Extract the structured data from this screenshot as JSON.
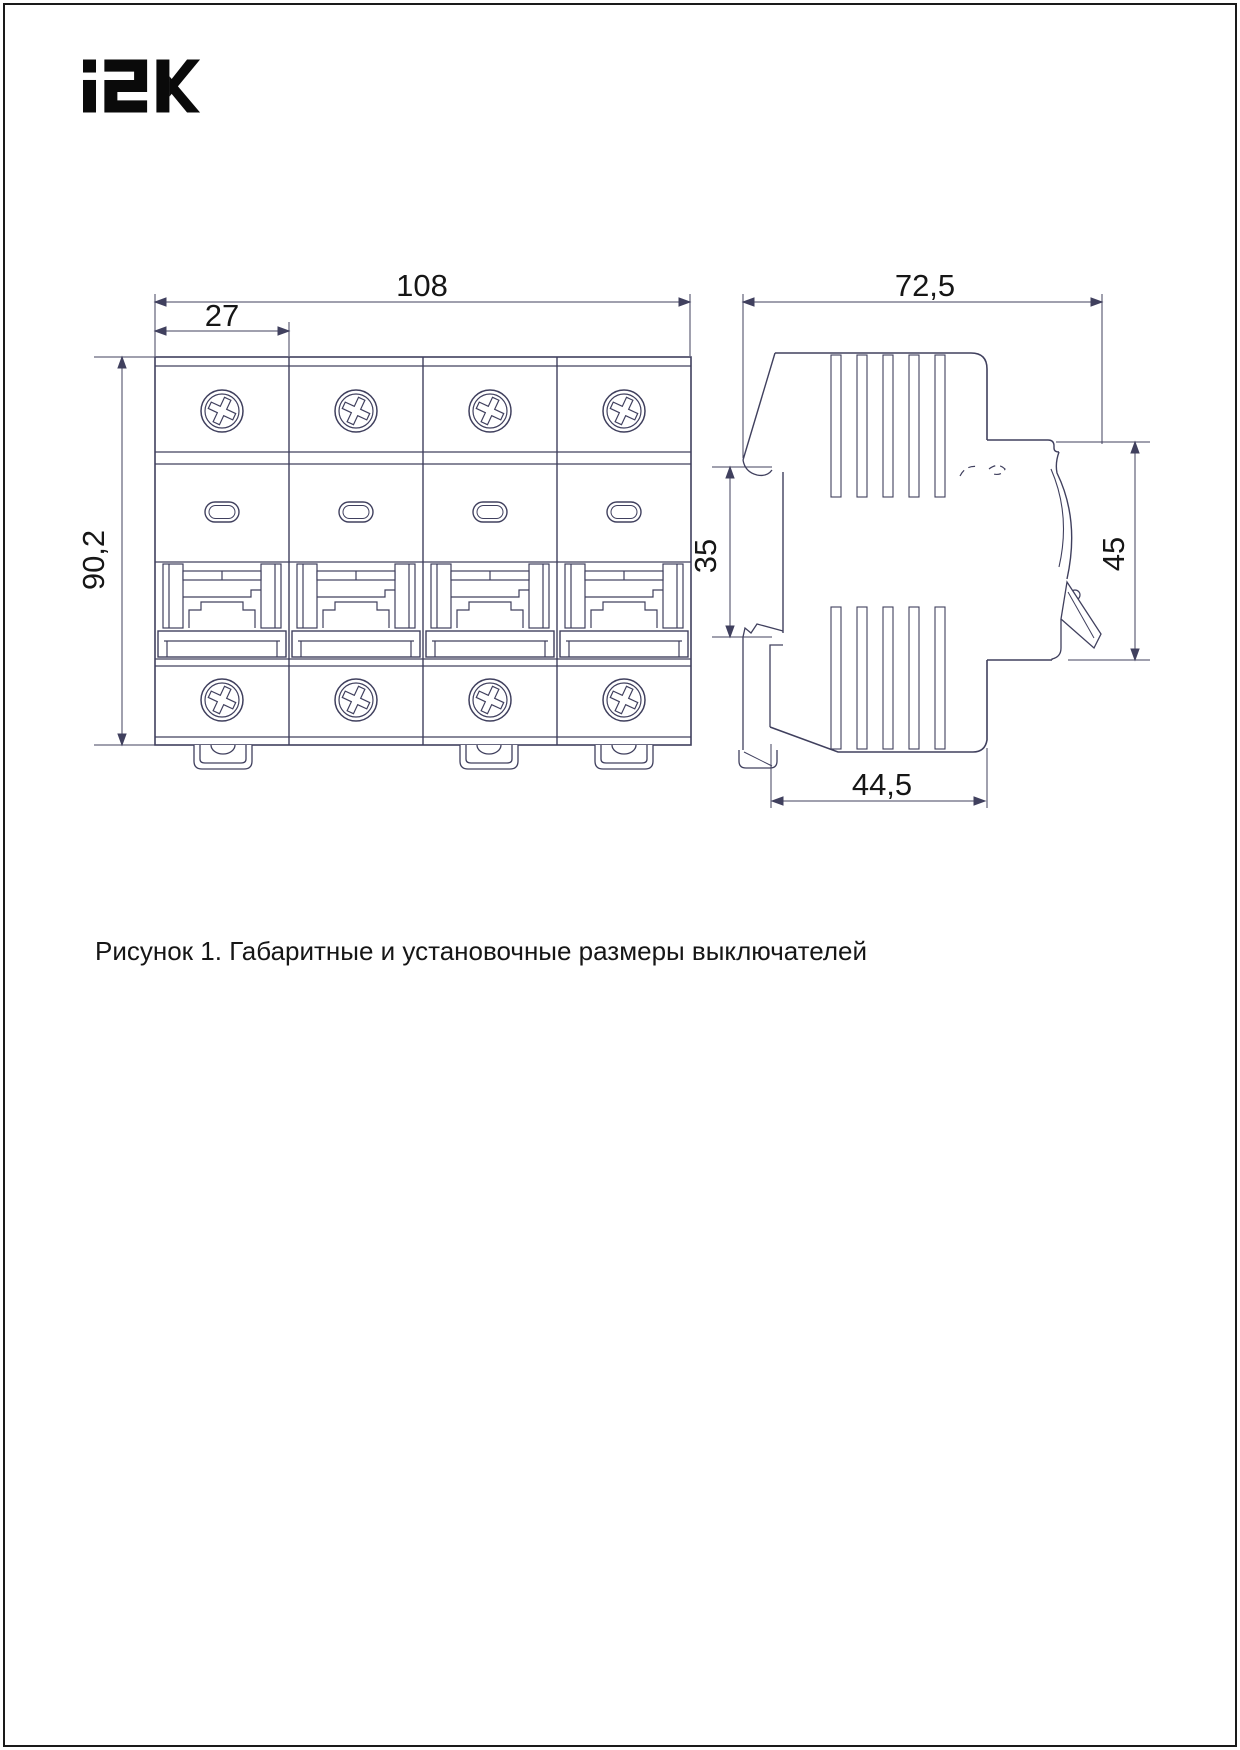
{
  "brand": {
    "logo_text": "iEK"
  },
  "caption": "Рисунок 1. Габаритные и установочные размеры выключателей",
  "front_view": {
    "poles": 4,
    "dims": {
      "overall_width": "108",
      "pole_width": "27",
      "overall_height": "90,2"
    }
  },
  "side_view": {
    "dims": {
      "overall_depth": "72,5",
      "din_rail_height": "35",
      "front_part_height": "45",
      "mounting_depth": "44,5"
    }
  },
  "colors": {
    "line": "#40405e",
    "text": "#161616",
    "logo": "#0a0a0a",
    "frame": "#1a1a1a"
  }
}
